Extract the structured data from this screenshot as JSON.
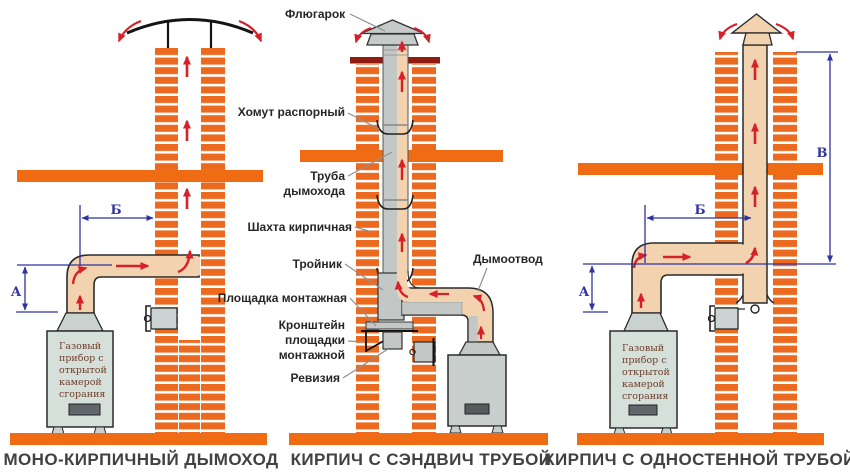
{
  "captions": {
    "left": "МОНО-КИРПИЧНЫЙ ДЫМОХОД",
    "middle": "КИРПИЧ С СЭНДВИЧ ТРУБОЙ",
    "right": "КИРПИЧ С ОДНОСТЕННОЙ ТРУБОЙ"
  },
  "labels": {
    "flyugarok": "Флюгарок",
    "khomut": "Хомут распорный",
    "truba_1": "Труба",
    "truba_2": "дымохода",
    "shakhta": "Шахта кирпичная",
    "troynik": "Тройник",
    "ploshchadka": "Площадка монтажная",
    "kronshteyn_1": "Кронштейн",
    "kronshteyn_2": "площадки",
    "kronshteyn_3": "монтажной",
    "reviziya": "Ревизия",
    "dymootvod": "Дымоотвод"
  },
  "dims": {
    "a": "А",
    "b": "Б",
    "v": "В"
  },
  "boiler_text": [
    "Газовый",
    "прибор с",
    "открытой",
    "камерой",
    "сгорания"
  ],
  "colors": {
    "brick": "#EC6A20",
    "slab": "#EF6C15",
    "crown": "#8E1A10",
    "duct_tan": "#F3D2B0",
    "metal_gray": "#C3C8C7",
    "boiler_gray": "#D6E0DA",
    "dimension_blue": "#2F33A0",
    "arrow_red": "#D7212A"
  }
}
